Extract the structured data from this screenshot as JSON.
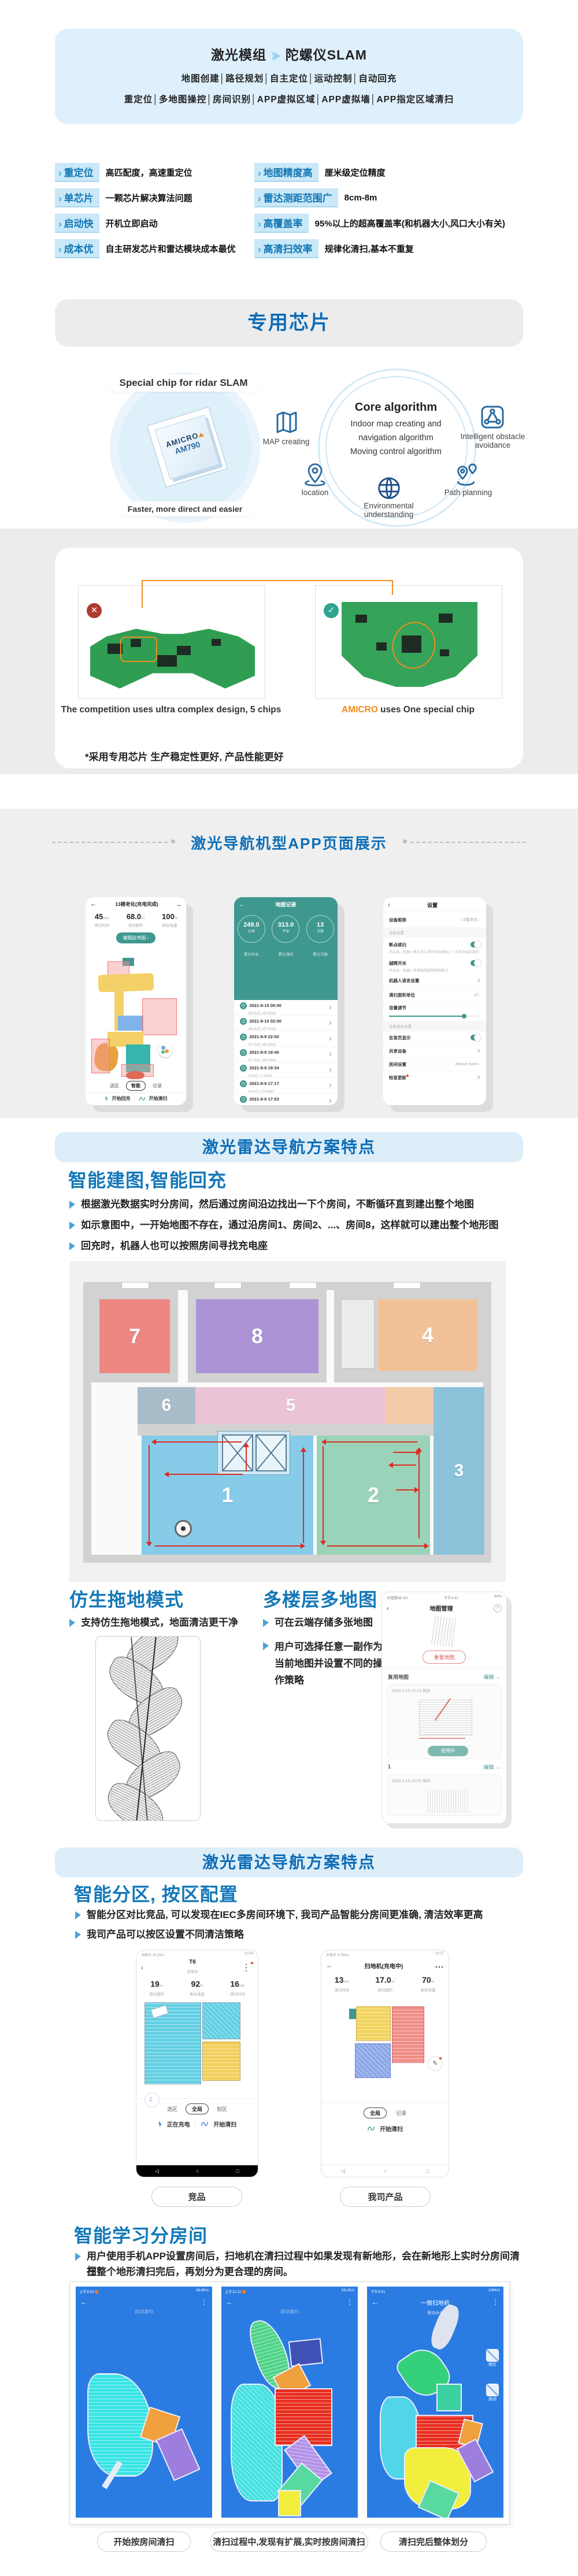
{
  "colors": {
    "accent_blue": "#1377b5",
    "banner_blue": "#0d6cb7",
    "teal": "#3f988f",
    "badge_bg": "#c9e8f8",
    "hero_bg": "#def0fb",
    "phone_map_blue": "#2b7ce2"
  },
  "hero": {
    "title_left": "激光模组",
    "title_right": "陀螺仪SLAM",
    "line1": "地图创建│路径规划│自主定位│运动控制│自动回充",
    "line2": "重定位│多地图操控│房间识别│APP虚拟区域│APP虚拟墙│APP指定区域清扫"
  },
  "features": {
    "items": [
      {
        "badge": "重定位",
        "desc": "高匹配度，高速重定位"
      },
      {
        "badge": "地图精度高",
        "desc": "厘米级定位精度"
      },
      {
        "badge": "单芯片",
        "desc": "一颗芯片解决算法问题"
      },
      {
        "badge": "雷达测距范围广",
        "desc": "8cm-8m"
      },
      {
        "badge": "启动快",
        "desc": "开机立即启动"
      },
      {
        "badge": "高覆盖率",
        "desc": "95%以上的超高覆盖率(和机器大小,风口大小有关)"
      },
      {
        "badge": "成本优",
        "desc": "自主研发芯片和雷达模块成本最优"
      },
      {
        "badge": "高清扫效率",
        "desc": "规律化清扫,基本不重复"
      }
    ]
  },
  "chip": {
    "banner": "专用芯片",
    "special_label": "Special chip for ridar SLAM",
    "brand": "AMICRO",
    "model": "AM790",
    "fast_caption": "Faster, more direct and easier",
    "core_title": "Core algorithm",
    "core_line1": "Indoor map creating and",
    "core_line2": "navigation algorithm",
    "core_line3": "Moving control algorithm",
    "icon_map": "MAP creating",
    "icon_location": "location",
    "icon_env": "Environmental understanding",
    "icon_path": "Path planning",
    "icon_obstacle": "Intelligent obstacle avoidance",
    "left_caption": "The competition uses ultra complex design, 5 chips",
    "right_brand": "AMICRO",
    "right_caption": " uses One special chip",
    "note": "*采用专用芯片 生产稳定性更好, 产品性能更好",
    "x_mark": "✕",
    "check_mark": "✓"
  },
  "app": {
    "title": "激光导航机型APP页面展示",
    "p1": {
      "back": "←",
      "menu": "…",
      "title": "13楼老化(充电完成)",
      "s1v": "45",
      "s1u": "min",
      "s1l": "清扫时间",
      "s2v": "68.0",
      "s2u": "㎡",
      "s2l": "清扫面积",
      "s3v": "100",
      "s3u": "%",
      "s3l": "剩余电量",
      "edit": "编辑此地图 ›",
      "tab1": "选区",
      "tab2": "智能",
      "tab3": "记录",
      "btn1": "开始回充",
      "btn2": "开始清扫"
    },
    "p2": {
      "back": "←",
      "title": "地图记录",
      "c1v": "249.0",
      "c1u": "分钟",
      "c1l": "累计时长",
      "c2v": "313.0",
      "c2u": "平米",
      "c2l": "累计清扫",
      "c3v": "13",
      "c3u": "次数",
      "c3l": "累计次数",
      "recs": [
        {
          "t": "2021-8-10 06:00",
          "d": "68.0㎡ | 45.0min"
        },
        {
          "t": "2021-8-10 02:00",
          "d": "68.0㎡ | 47.0min"
        },
        {
          "t": "2021-8-9 22:00",
          "d": "67.0㎡ | 46.0min"
        },
        {
          "t": "2021-8-9 19:40",
          "d": "67.0㎡ | 54.0min"
        },
        {
          "t": "2021-8-9 19:34",
          "d": "4.0㎡ | 1.0min"
        },
        {
          "t": "2021-8-9 17:17",
          "d": "6.0㎡ | 13.0min"
        },
        {
          "t": "2021-8-9 17:03",
          "d": "3.0㎡ | 7.4min"
        }
      ]
    },
    "p3": {
      "back": "‹",
      "title": "设置",
      "nickname": "设备昵称",
      "nickname_v": "13楼老化",
      "sec1": "功能设置",
      "resume": "断点续扫",
      "resume_desc": "开启后，机器人再次进入清扫时会继续上一次未完成的清扫",
      "obstacle": "越障开关",
      "obstacle_desc": "开启后，机器人将增强跨越障碍的能力",
      "lang": "机器人语言设置",
      "unit": "清扫面积单位",
      "unit_v": "㎡",
      "volume": "音量调节",
      "sec2": "设备基本设置",
      "home": "在首页显示",
      "share": "共享设备",
      "room": "房间设置",
      "room_v": "default room",
      "update": "检查更新"
    }
  },
  "nav1": {
    "banner": "激光雷达导航方案特点",
    "heading": "智能建图,智能回充",
    "b1": "根据激光数据实时分房间，然后通过房间沿边找出一下个房间，不断循环直到建出整个地图",
    "b2": "如示意图中，一开始地图不存在，通过沿房间1、房间2、...、房间8，这样就可以建出整个地形图",
    "b3": "回充时，机器人也可以按照房间寻找充电座",
    "rooms": [
      "1",
      "2",
      "3",
      "4",
      "5",
      "6",
      "7",
      "8"
    ]
  },
  "mop": {
    "heading": "仿生拖地模式",
    "bullet": "支持仿生拖地模式，地面清洁更干净"
  },
  "mmap": {
    "heading": "多楼层多地图",
    "b1": "可在云端存储多张地图",
    "b2": "用户可选择任意一副作为当前地图并设置不同的操作策略",
    "phone": {
      "carrier": "中国移动 4G",
      "time": "下午4:41",
      "batt": "44%",
      "back": "‹",
      "title": "地图管理",
      "help": "?",
      "reset": "重置地图",
      "sec1": "复用地图",
      "edit": "编辑 →",
      "card1_time": "2020.4.15 15:13 保存",
      "tag": "使用中",
      "sec2": "1",
      "card2_time": "2020.4.15 16:03 保存"
    }
  },
  "zones": {
    "banner": "激光雷达导航方案特点",
    "heading": "智能分区, 按区配置",
    "b1": "智能分区对比竞品, 可以发现在IEC多房间环境下, 我司产品智能分房间更准确, 清洁效率更高",
    "b2": "我司产品可以按区设置不同清洁策略",
    "pa": {
      "status_l": "未插卡 15.2K/s",
      "status_r": "10:54",
      "back": "‹",
      "title": "T6",
      "sub": "充电中",
      "menu": "⋮",
      "s1v": "19",
      "s1u": "㎡",
      "s1l": "清扫面积",
      "s2v": "92",
      "s2u": "%",
      "s2l": "剩余电量",
      "s3v": "16",
      "s3u": "min",
      "s3l": "清扫时间",
      "tab1": "选区",
      "tab2": "全局",
      "tab3": "划区",
      "btn1": "正在充电",
      "btn2": "开始清扫",
      "caption": "竞品"
    },
    "pb": {
      "status_l": "未插卡 6.78K/s",
      "status_r": "10:27",
      "back": "←",
      "title": "扫地机(充电中)",
      "menu": "…",
      "s1v": "13",
      "s1u": "min",
      "s1l": "清扫时间",
      "s2v": "17.0",
      "s2u": "㎡",
      "s2l": "清扫面积",
      "s3v": "70",
      "s3u": "%",
      "s3l": "剩余电量",
      "tab1": "全局",
      "tab2": "记录",
      "btn2": "开始清扫",
      "caption": "我司产品"
    }
  },
  "learn": {
    "heading": "智能学习分房间",
    "b1": "用户使用手机APP设置房间后，扫地机在清扫过程中如果发现有新地形，会在新地形上实时分房间清扫，",
    "b2": "在整个地形清扫完后，再划分为更合理的房间。",
    "p1": {
      "time": "上午9:52",
      "speed": "36.6K/s",
      "title": "自动清扫",
      "cap": "开始按房间清扫"
    },
    "p2": {
      "time": "上午11:11",
      "speed": "58.2K/s",
      "title": "自动清扫",
      "cap": "清扫过程中,发现有扩展,实时按房间清扫"
    },
    "p3": {
      "time": "下午4:01",
      "speed": "106K/s",
      "title": "一微扫地机",
      "sub": "等待命令",
      "cap": "清扫完后整体划分",
      "z1": "禁区",
      "z2": "房间"
    }
  }
}
